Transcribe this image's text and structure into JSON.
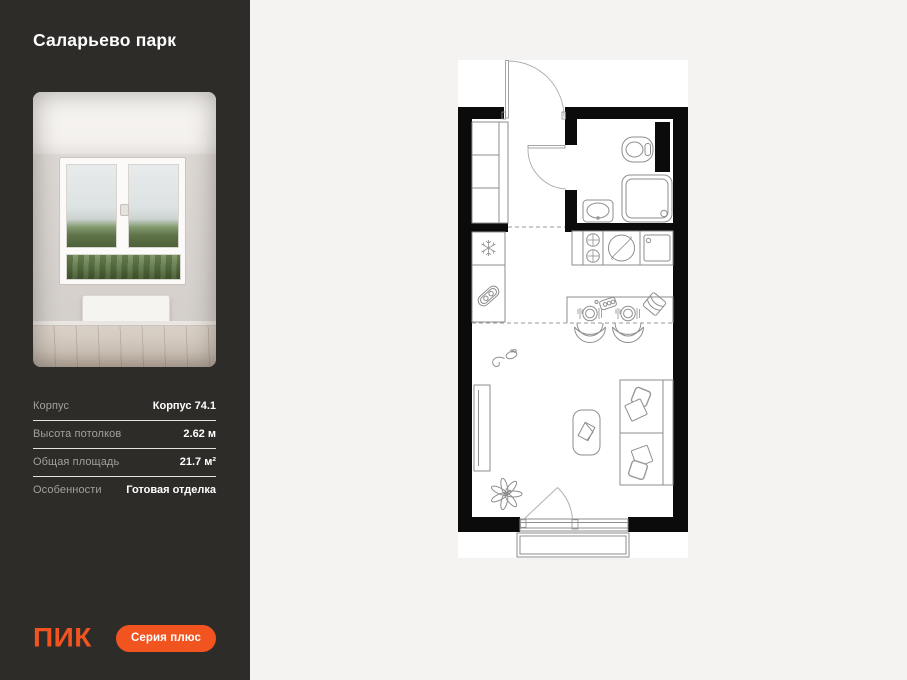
{
  "sidebar": {
    "title": "Саларьево парк",
    "specs": [
      {
        "label": "Корпус",
        "value": "Корпус 74.1"
      },
      {
        "label": "Высота потолков",
        "value": "2.62 м"
      },
      {
        "label": "Общая площадь",
        "value": "21.7 м²"
      },
      {
        "label": "Особенности",
        "value": "Готовая отделка"
      }
    ],
    "logo_text": "ПИК",
    "series_badge": "Серия плюс"
  },
  "colors": {
    "sidebar_bg": "#2D2C29",
    "accent_orange": "#F2541F",
    "page_bg": "#F4F3F1",
    "plan_wall": "#0B0B0B",
    "plan_line": "#8E8E8E"
  },
  "floorplan": {
    "type": "studio-apartment-plan",
    "fixtures": [
      "entry-door",
      "wardrobe",
      "bathroom-toilet",
      "bathroom-shower",
      "bathroom-sink",
      "bathroom-door",
      "duct-shaft",
      "refrigerator-icon",
      "kitchen-cabinet-icon",
      "stove-burners-icon",
      "hob-icon",
      "kitchen-sink-icon",
      "dining-table",
      "place-settings",
      "chairs",
      "tv-unit",
      "coffee-table",
      "sofa-bed",
      "pillows",
      "plant-icon",
      "mouse-toy-icon",
      "balcony-door",
      "balcony"
    ]
  }
}
